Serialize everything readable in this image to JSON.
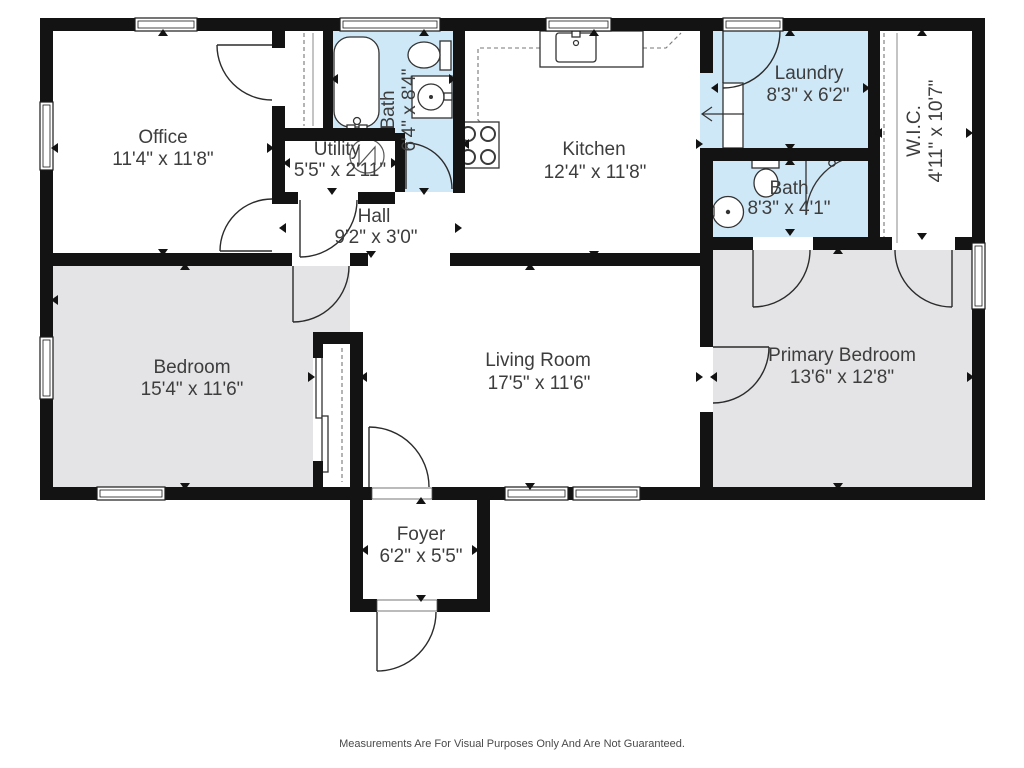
{
  "title": "Floor plan",
  "footer": {
    "disclaimer": "Measurements Are For Visual Purposes Only And Are Not Guaranteed."
  },
  "colors": {
    "wall": "#131313",
    "wet_room": "#cfe8f7",
    "carpet_room": "#e4e4e6",
    "label_text": "#3d3d3d"
  },
  "rooms": [
    {
      "id": "office",
      "name": "Office",
      "dims": "11'4\" x 11'8\""
    },
    {
      "id": "utility",
      "name": "Utility",
      "dims": "5'5\" x 2'11\""
    },
    {
      "id": "bath",
      "name": "Bath",
      "dims": "6'4\" x 8'4\""
    },
    {
      "id": "hall",
      "name": "Hall",
      "dims": "9'2\" x 3'0\""
    },
    {
      "id": "kitchen",
      "name": "Kitchen",
      "dims": "12'4\" x 11'8\""
    },
    {
      "id": "laundry",
      "name": "Laundry",
      "dims": "8'3\" x 6'2\""
    },
    {
      "id": "bath2",
      "name": "Bath",
      "dims": "8'3\" x 4'1\""
    },
    {
      "id": "wic",
      "name": "W.I.C.",
      "dims": "4'11\" x 10'7\""
    },
    {
      "id": "bedroom",
      "name": "Bedroom",
      "dims": "15'4\" x 11'6\""
    },
    {
      "id": "living",
      "name": "Living Room",
      "dims": "17'5\" x 11'6\""
    },
    {
      "id": "primary",
      "name": "Primary Bedroom",
      "dims": "13'6\" x 12'8\""
    },
    {
      "id": "foyer",
      "name": "Foyer",
      "dims": "6'2\" x 5'5\""
    }
  ]
}
